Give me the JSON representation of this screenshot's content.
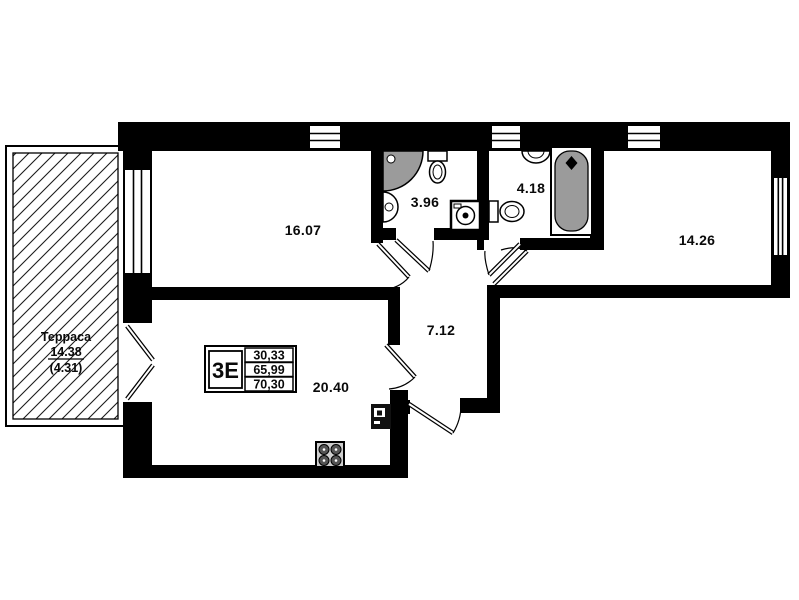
{
  "rooms": {
    "bedroom1": "16.07",
    "bathroom1": "3.96",
    "bathroom2": "4.18",
    "bedroom2": "14.26",
    "hallway": "7.12",
    "living_kitchen": "20.40"
  },
  "terrace": {
    "name": "Терраса",
    "area": "14.38",
    "coefficient_area": "(4.31)"
  },
  "unit_card": {
    "type": "3Е",
    "values": [
      "30,33",
      "65,99",
      "70,30"
    ]
  },
  "colors": {
    "walls": "#000000",
    "fixtures": "#9b9b9b",
    "background": "#ffffff"
  }
}
